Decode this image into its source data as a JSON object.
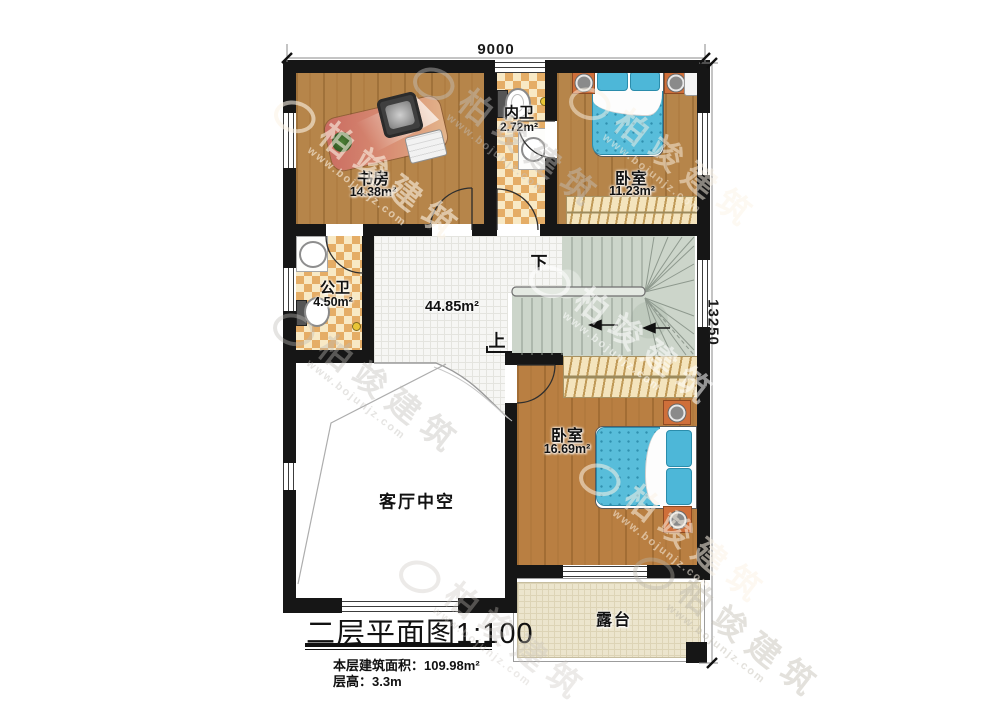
{
  "plan": {
    "dimension_top": "9000",
    "dimension_right": "13250",
    "rooms": {
      "study": {
        "name": "书房",
        "area": "14.38m²"
      },
      "inner_bath": {
        "name": "内卫",
        "area": "2.72m²"
      },
      "bedroom1": {
        "name": "卧室",
        "area": "11.23m²"
      },
      "public_bath": {
        "name": "公卫",
        "area": "4.50m²"
      },
      "hall": {
        "area": "44.85m²"
      },
      "bedroom2": {
        "name": "卧室",
        "area": "16.69m²"
      },
      "void": {
        "name": "客厅中空"
      },
      "terrace": {
        "name": "露台"
      }
    },
    "stairs": {
      "down_label": "下",
      "up_label": "上"
    },
    "title": "二层平面图1:100",
    "floor_area_note": "本层建筑面积：109.98m²",
    "floor_height_note": "层高：3.3m",
    "watermark": {
      "brand": "柏竣建筑",
      "url": "www.bojunjz.com"
    },
    "colors": {
      "wall": "#161616",
      "wood": "#b6854a",
      "wood_warm": "#b97f42",
      "checker": "#e5ad66",
      "tile": "#f6f6f4",
      "stair": "#ccd5ca",
      "terrace": "#ece5cd",
      "bed": "#58bdda",
      "cabinet_accent": "#cf6f3a"
    }
  }
}
